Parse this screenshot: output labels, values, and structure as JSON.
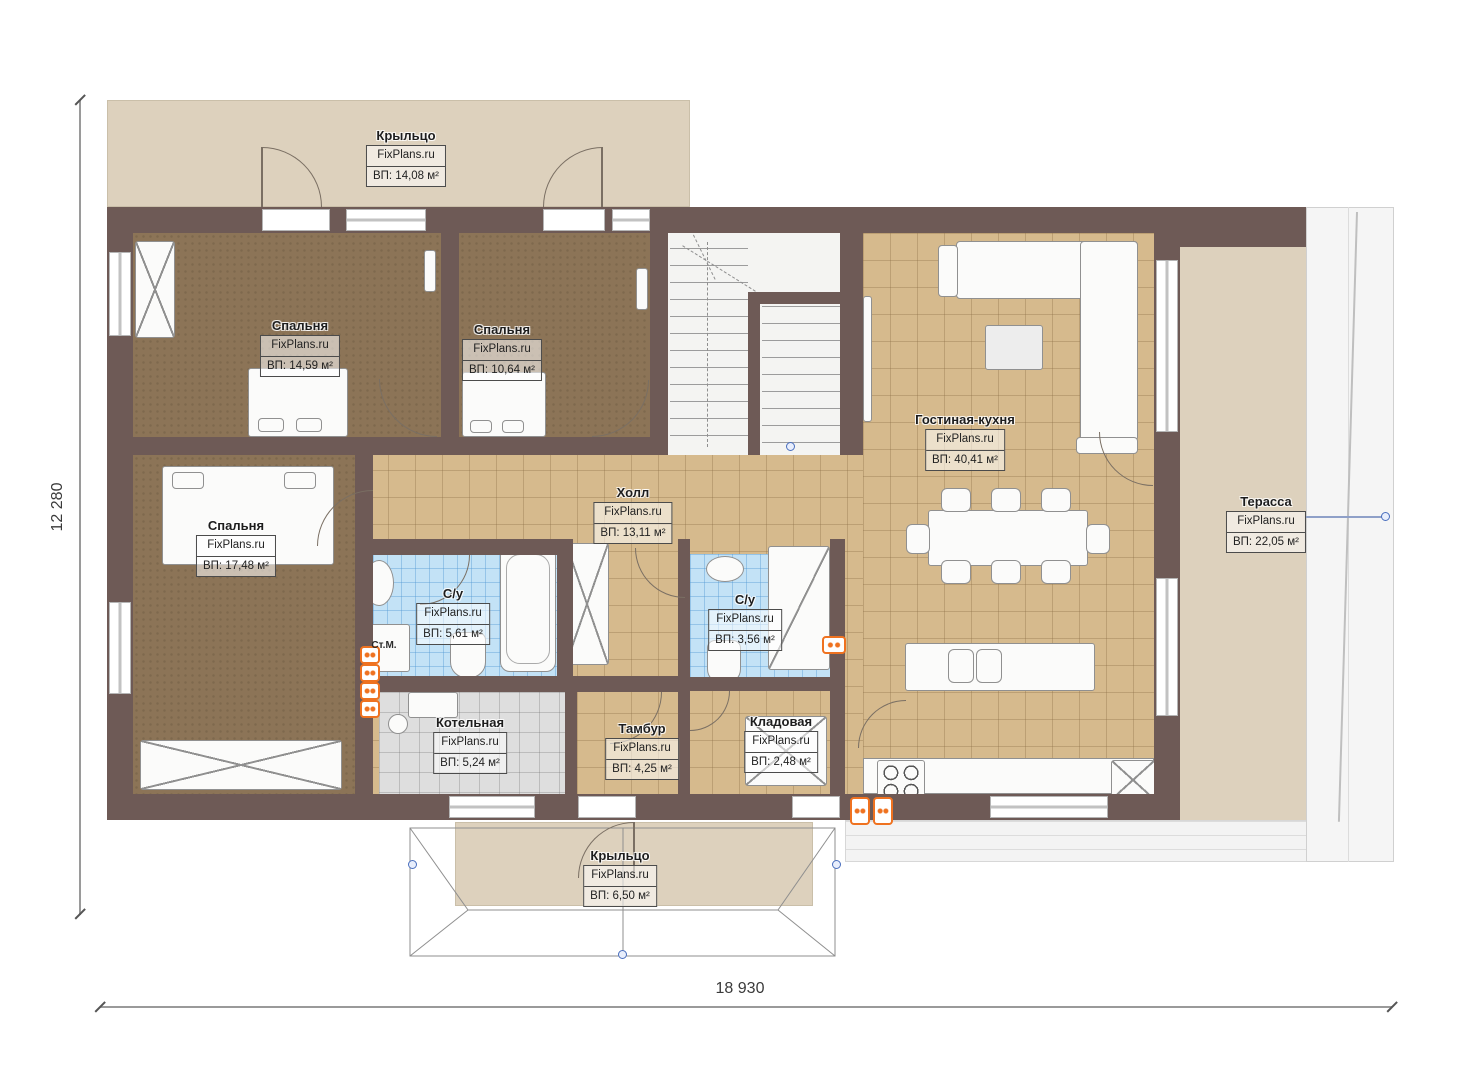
{
  "brand": "FixPlans.ru",
  "plan": {
    "width_dimension": "18 930",
    "height_dimension": "12 280"
  },
  "rooms": [
    {
      "id": "porch_top",
      "name": "Крыльцо",
      "area": "ВП: 14,08 м²"
    },
    {
      "id": "bedroom_1",
      "name": "Спальня",
      "area": "ВП: 14,59 м²"
    },
    {
      "id": "bedroom_2",
      "name": "Спальня",
      "area": "ВП: 10,64 м²"
    },
    {
      "id": "bedroom_3",
      "name": "Спальня",
      "area": "ВП: 17,48 м²"
    },
    {
      "id": "hall",
      "name": "Холл",
      "area": "ВП: 13,11 м²"
    },
    {
      "id": "living_kitchen",
      "name": "Гостиная-кухня",
      "area": "ВП: 40,41 м²"
    },
    {
      "id": "terrace",
      "name": "Терасса",
      "area": "ВП: 22,05 м²"
    },
    {
      "id": "bathroom_1",
      "name": "С/у",
      "area": "ВП: 5,61 м²"
    },
    {
      "id": "bathroom_2",
      "name": "С/у",
      "area": "ВП: 3,56 м²"
    },
    {
      "id": "boiler_room",
      "name": "Котельная",
      "area": "ВП: 5,24 м²"
    },
    {
      "id": "vestibule",
      "name": "Тамбур",
      "area": "ВП: 4,25 м²"
    },
    {
      "id": "storage",
      "name": "Кладовая",
      "area": "ВП: 2,48 м²"
    },
    {
      "id": "porch_bottom",
      "name": "Крыльцо",
      "area": "ВП: 6,50 м²"
    }
  ],
  "labels": {
    "washing_machine": "Ст.М."
  },
  "colors": {
    "wall": "#6e5a56",
    "tile_floor": "#d6ba8d",
    "bedroom_floor": "#8c7457",
    "bathroom_tile": "#c3e2f6",
    "boiler_floor": "#dedede",
    "porch_floor": "#ddd1bd",
    "radiator": "#ef7220",
    "dimension_dot": "#4a6fbe"
  }
}
